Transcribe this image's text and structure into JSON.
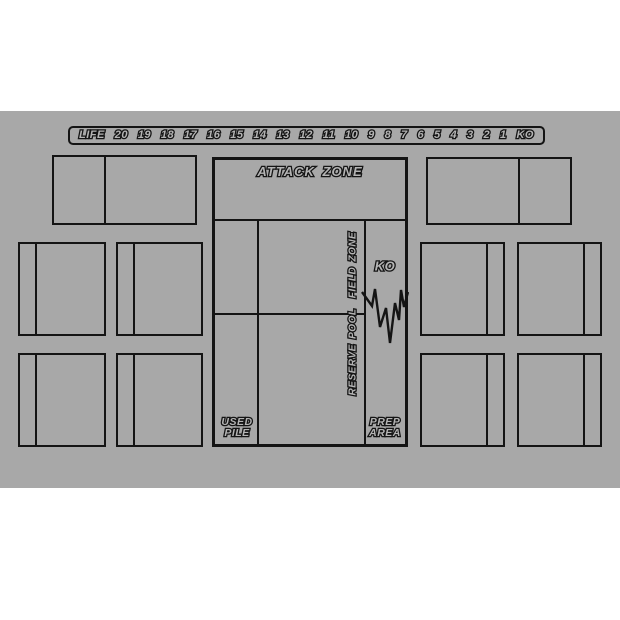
{
  "mat": {
    "background_color": "#a8a8a8",
    "line_color": "#141414",
    "text_fill_color": "#b4b4b4"
  },
  "life_track": {
    "label": "LIFE",
    "values": [
      "20",
      "19",
      "18",
      "17",
      "16",
      "15",
      "14",
      "13",
      "12",
      "11",
      "10",
      "9",
      "8",
      "7",
      "6",
      "5",
      "4",
      "3",
      "2",
      "1",
      "KO"
    ]
  },
  "zones": {
    "attack_zone": "ATTACK ZONE",
    "field_zone": "FIELD ZONE",
    "reserve_pool": "RESERVE POOL",
    "ko": "KO",
    "used_pile": {
      "line1": "USED",
      "line2": "PILE"
    },
    "prep_area": {
      "line1": "PREP",
      "line2": "AREA"
    }
  }
}
